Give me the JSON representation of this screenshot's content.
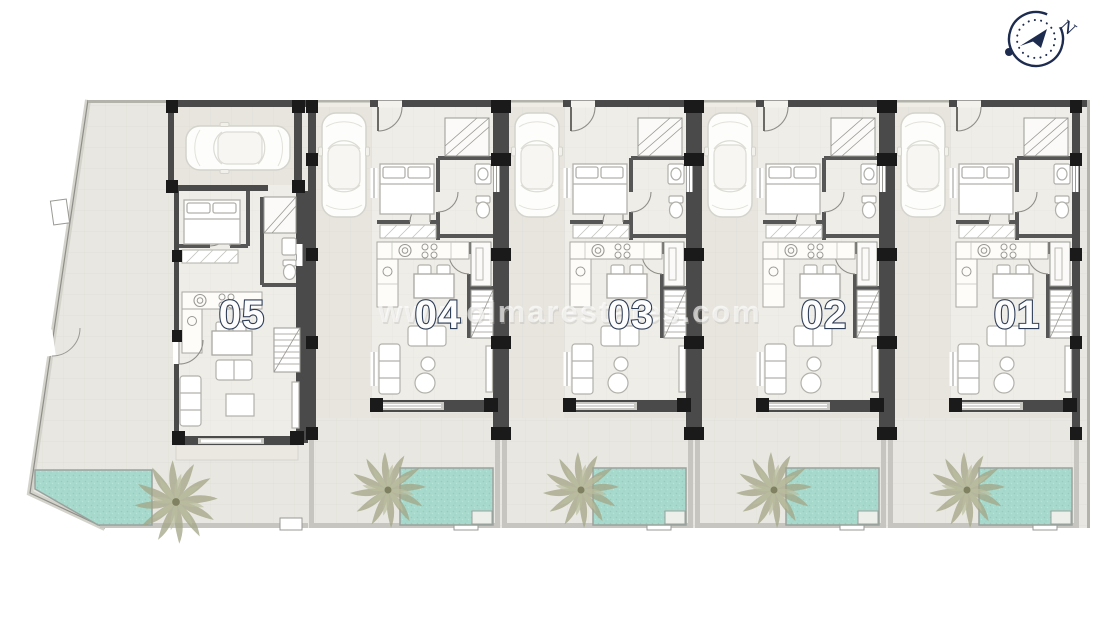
{
  "watermark": {
    "text": "www.olmarestates.com"
  },
  "compass": {
    "north_label": "N"
  },
  "plan": {
    "units": [
      {
        "number": "05"
      },
      {
        "number": "04"
      },
      {
        "number": "03"
      },
      {
        "number": "02"
      },
      {
        "number": "01"
      }
    ],
    "unit_features": [
      "driveway/garage with car",
      "bedroom",
      "bathroom",
      "staircase",
      "kitchen",
      "dining area",
      "living room",
      "terrace",
      "garden",
      "private pool",
      "palm tree"
    ],
    "colors": {
      "ground": "#e9e7e1",
      "interior_floor": "#efede8",
      "walls": "#4a4a4a",
      "columns": "#1a1a1a",
      "pool_water": "#a7d9cc",
      "palm": "#a3a586",
      "label_ink": "#2e3d57",
      "compass_ink": "#1d2b4f",
      "fence": "#c6c5bf"
    }
  }
}
